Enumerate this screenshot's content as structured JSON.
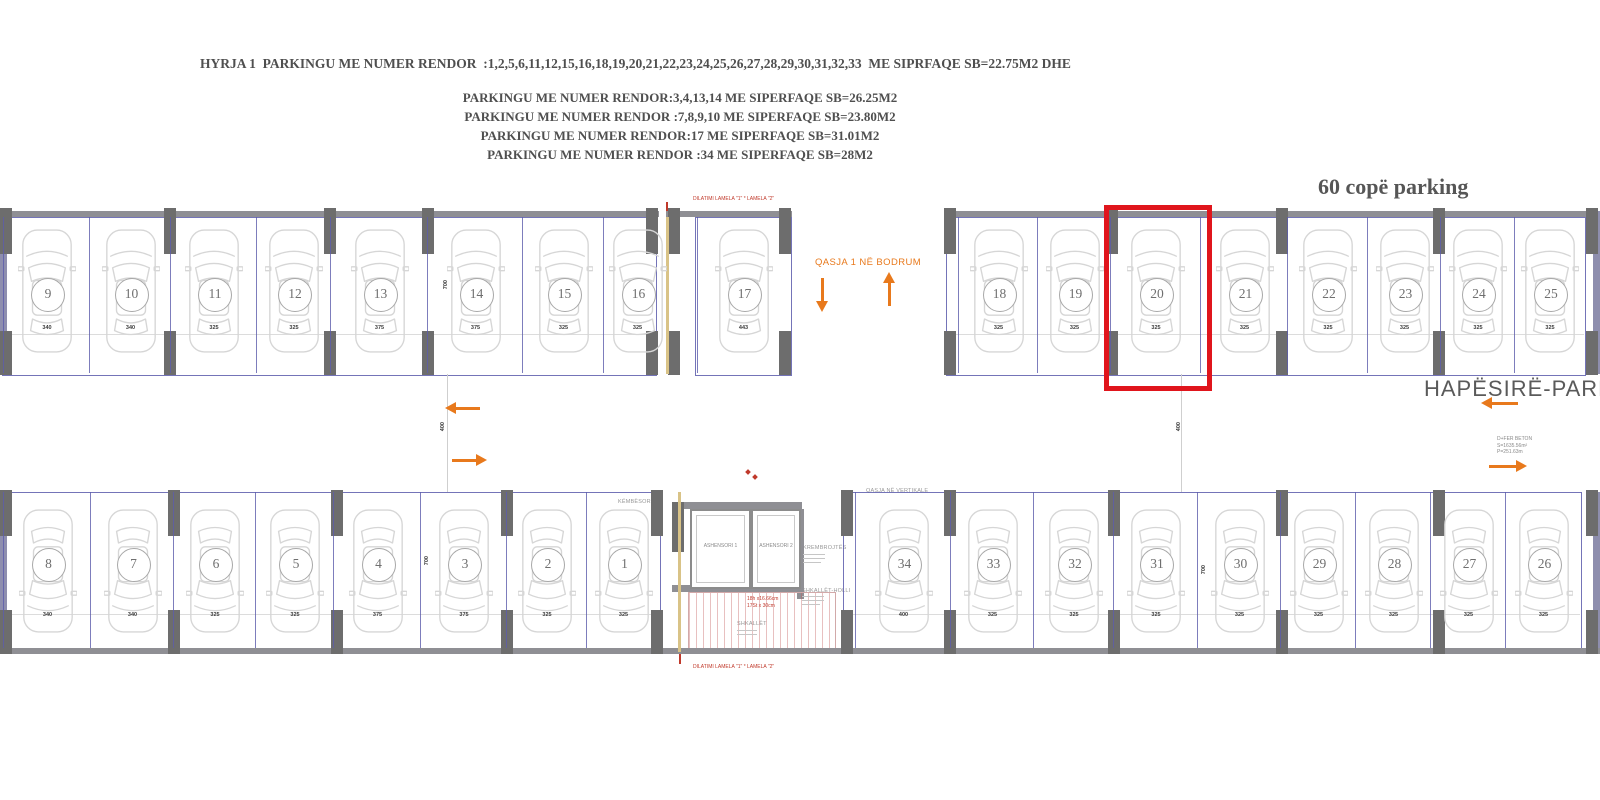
{
  "header": {
    "line1": "HYRJA 1  PARKINGU ME NUMER RENDOR  :1,2,5,6,11,12,15,16,18,19,20,21,22,23,24,25,26,27,28,29,30,31,32,33  ME SIPRFAQE SB=22.75M2 DHE",
    "lines": [
      "PARKINGU ME  NUMER RENDOR:3,4,13,14  ME SIPERFAQE  SB=26.25M2",
      "PARKINGU  ME NUMER RENDOR :7,8,9,10 ME SIPERFAQE  SB=23.80M2",
      "PARKINGU ME NUMER RENDOR:17 ME SIPERFAQE  SB=31.01M2",
      "PARKINGU ME NUMER RENDOR :34  ME SIPERFAQE  SB=28M2"
    ],
    "parking_count": "60 copë parking"
  },
  "plan": {
    "top_row": [
      {
        "num": "9",
        "dim": "340"
      },
      {
        "num": "10",
        "dim": "340"
      },
      {
        "num": "11",
        "dim": "325"
      },
      {
        "num": "12",
        "dim": "325"
      },
      {
        "num": "13",
        "dim": "375"
      },
      {
        "num": "14",
        "dim": "375"
      },
      {
        "num": "15",
        "dim": "325"
      },
      {
        "num": "16",
        "dim": "325"
      },
      {
        "num": "17",
        "dim": "443"
      },
      {
        "num": "18",
        "dim": "325"
      },
      {
        "num": "19",
        "dim": "325"
      },
      {
        "num": "20",
        "dim": "325"
      },
      {
        "num": "21",
        "dim": "325"
      },
      {
        "num": "22",
        "dim": "325"
      },
      {
        "num": "23",
        "dim": "325"
      },
      {
        "num": "24",
        "dim": "325"
      },
      {
        "num": "25",
        "dim": "325"
      }
    ],
    "bottom_row": [
      {
        "num": "8",
        "dim": "340"
      },
      {
        "num": "7",
        "dim": "340"
      },
      {
        "num": "6",
        "dim": "325"
      },
      {
        "num": "5",
        "dim": "325"
      },
      {
        "num": "4",
        "dim": "375"
      },
      {
        "num": "3",
        "dim": "375"
      },
      {
        "num": "2",
        "dim": "325"
      },
      {
        "num": "1",
        "dim": "325"
      },
      {
        "num": "34",
        "dim": "400"
      },
      {
        "num": "33",
        "dim": "325"
      },
      {
        "num": "32",
        "dim": "325"
      },
      {
        "num": "31",
        "dim": "325"
      },
      {
        "num": "30",
        "dim": "325"
      },
      {
        "num": "29",
        "dim": "325"
      },
      {
        "num": "28",
        "dim": "325"
      },
      {
        "num": "27",
        "dim": "325"
      },
      {
        "num": "26",
        "dim": "325"
      }
    ],
    "highlighted_spot": "20",
    "labels": {
      "dilatimi": "DILATIMI LAMELA \"1\" * LAMELA \"2\"",
      "qasja_bodrum": "QASJA 1 NË BODRUM",
      "qasja_vertikale": "QASJA NË VERTIKALE",
      "kembesoret": "KËMBËSORËT",
      "hapesire_parking": "HAPËSIRË-PARKING",
      "ashensori_1": "ASHENSORI 1",
      "ashensori_2": "ASHENSORI 2",
      "krembrojtes": "KREMBROJTËS",
      "shkallet": "SHKALLËT",
      "shkallet_holli": "SHKALLËT-HOLLI",
      "stair_note_1": "H=300cm",
      "stair_note_2": "18h x16.66cm",
      "stair_note_3": "17St x 30cm",
      "fer_beton_1": "D+FER BETON",
      "fer_beton_2": "S=1635.56m²",
      "fer_beton_3": "P=251.63m",
      "dim_700": "700",
      "dim_400": "400"
    },
    "colors": {
      "highlight": "#e0151c",
      "accent_orange": "#e8791c",
      "line_blue": "#5c5cab",
      "wall_gray": "#8f8f94",
      "annotation_red": "#c0392b"
    }
  }
}
